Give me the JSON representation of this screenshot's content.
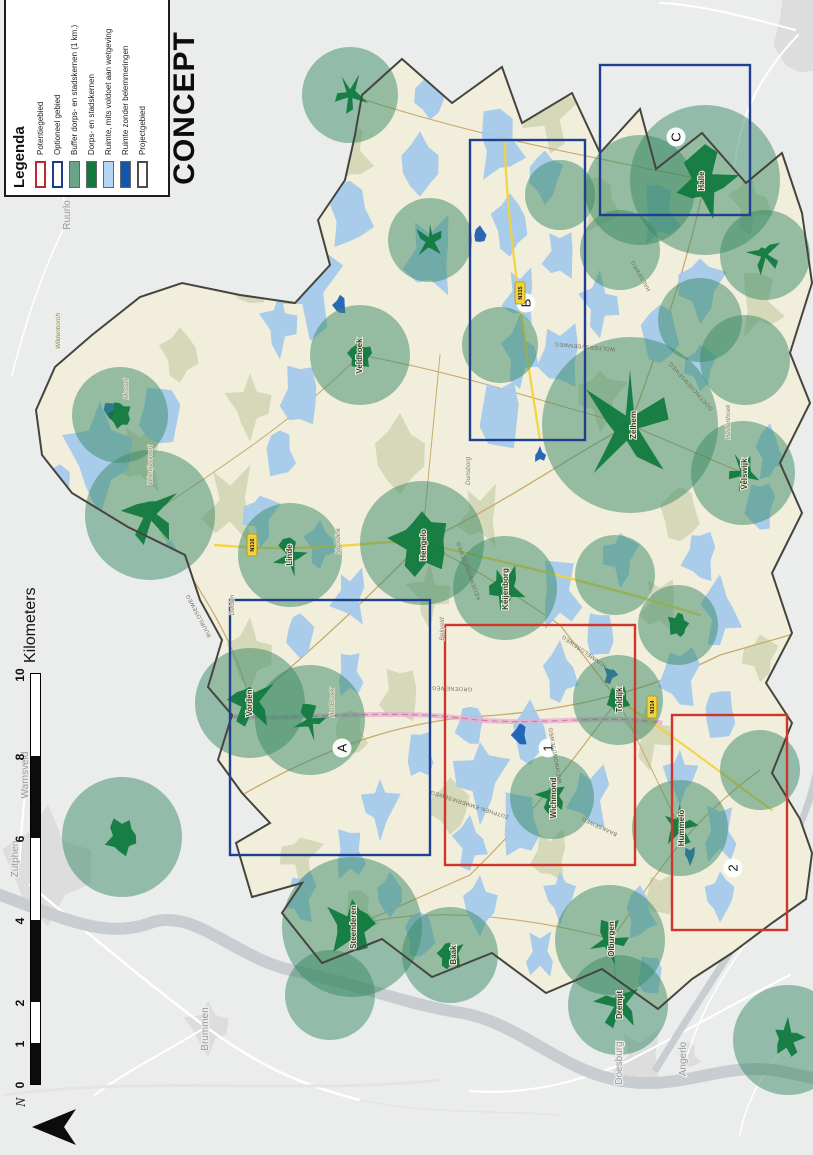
{
  "page": {
    "concept_label": "CONCEPT"
  },
  "legend": {
    "title": "Legenda",
    "items": [
      {
        "label": "Potentiegebied",
        "swatch": "outline",
        "color": "#c0272d"
      },
      {
        "label": "Optioneel gebied",
        "swatch": "outline",
        "color": "#1d3c87"
      },
      {
        "label": "Buffer dorps- en stadskernen (1 km.)",
        "swatch": "fill",
        "color": "#6ba387"
      },
      {
        "label": "Dorps- en stadskernen",
        "swatch": "fill",
        "color": "#15793f"
      },
      {
        "label": "Ruimte, mits voldoet aan wetgeving",
        "swatch": "fill",
        "color": "#b4d6f3"
      },
      {
        "label": "Ruimte zonder belemmeringen",
        "swatch": "fill",
        "color": "#1157ad"
      },
      {
        "label": "Projectgebied",
        "swatch": "outline",
        "color": "#4d4d4d"
      }
    ]
  },
  "scalebar": {
    "unit_label": "Kilometers",
    "ticks": [
      {
        "label": "0",
        "km": 0
      },
      {
        "label": "1",
        "km": 1
      },
      {
        "label": "2",
        "km": 2
      },
      {
        "label": "4",
        "km": 4
      },
      {
        "label": "6",
        "km": 6
      },
      {
        "label": "8",
        "km": 8
      },
      {
        "label": "10",
        "km": 10
      }
    ],
    "px_per_km": 41,
    "bar_left": 70
  },
  "north_arrow": {
    "label": "N"
  },
  "region_boxes": [
    {
      "label": "A",
      "type": "optioneel",
      "x": 300,
      "y": 230,
      "w": 255,
      "h": 200,
      "lx": 407,
      "ly": 342
    },
    {
      "label": "B",
      "type": "optioneel",
      "x": 715,
      "y": 470,
      "w": 300,
      "h": 115,
      "lx": 852,
      "ly": 526
    },
    {
      "label": "C",
      "type": "optioneel",
      "x": 940,
      "y": 600,
      "w": 150,
      "h": 150,
      "lx": 1018,
      "ly": 676
    },
    {
      "label": "1",
      "type": "potentie",
      "x": 290,
      "y": 445,
      "w": 240,
      "h": 190,
      "lx": 407,
      "ly": 548
    },
    {
      "label": "2",
      "type": "potentie",
      "x": 225,
      "y": 672,
      "w": 215,
      "h": 115,
      "lx": 287,
      "ly": 733
    }
  ],
  "map_features": {
    "buffers": [
      [
        1060,
        350,
        48,
        13
      ],
      [
        915,
        430,
        42,
        12
      ],
      [
        965,
        640,
        55,
        0
      ],
      [
        975,
        705,
        75,
        26
      ],
      [
        900,
        765,
        45,
        13
      ],
      [
        905,
        620,
        40,
        0
      ],
      [
        800,
        360,
        50,
        13
      ],
      [
        810,
        500,
        38,
        0
      ],
      [
        730,
        630,
        88,
        36
      ],
      [
        795,
        745,
        45,
        0
      ],
      [
        835,
        700,
        42,
        0
      ],
      [
        640,
        150,
        65,
        22
      ],
      [
        600,
        290,
        52,
        13
      ],
      [
        612,
        422,
        62,
        29
      ],
      [
        567,
        505,
        52,
        17
      ],
      [
        580,
        615,
        40,
        0
      ],
      [
        682,
        743,
        52,
        13
      ],
      [
        530,
        678,
        40,
        11
      ],
      [
        452,
        250,
        55,
        20
      ],
      [
        435,
        310,
        55,
        12
      ],
      [
        358,
        552,
        42,
        13
      ],
      [
        455,
        618,
        45,
        12
      ],
      [
        327,
        680,
        48,
        14
      ],
      [
        385,
        760,
        40,
        0
      ],
      [
        228,
        352,
        70,
        23
      ],
      [
        200,
        450,
        48,
        13
      ],
      [
        215,
        610,
        55,
        15
      ],
      [
        150,
        618,
        50,
        18
      ],
      [
        318,
        122,
        60,
        16
      ],
      [
        115,
        788,
        55,
        14
      ],
      [
        160,
        330,
        45,
        0
      ],
      [
        960,
        560,
        35,
        0
      ],
      [
        740,
        120,
        48,
        12
      ]
    ],
    "water_light": [
      [
        700,
        100,
        45,
        28
      ],
      [
        740,
        160,
        30,
        20
      ],
      [
        660,
        60,
        25,
        15
      ],
      [
        870,
        310,
        45,
        25
      ],
      [
        940,
        350,
        30,
        20
      ],
      [
        990,
        420,
        28,
        18
      ],
      [
        900,
        430,
        35,
        22
      ],
      [
        830,
        280,
        25,
        15
      ],
      [
        760,
        300,
        30,
        18
      ],
      [
        700,
        280,
        22,
        14
      ],
      [
        640,
        260,
        25,
        15
      ],
      [
        1010,
        500,
        30,
        20
      ],
      [
        1060,
        430,
        22,
        15
      ],
      [
        800,
        560,
        30,
        20
      ],
      [
        850,
        600,
        25,
        16
      ],
      [
        900,
        560,
        22,
        15
      ],
      [
        820,
        660,
        28,
        18
      ],
      [
        870,
        700,
        30,
        20
      ],
      [
        940,
        660,
        25,
        16
      ],
      [
        790,
        700,
        22,
        14
      ],
      [
        740,
        500,
        35,
        20
      ],
      [
        800,
        520,
        28,
        15
      ],
      [
        860,
        520,
        25,
        14
      ],
      [
        930,
        510,
        28,
        16
      ],
      [
        980,
        545,
        25,
        15
      ],
      [
        560,
        560,
        30,
        18
      ],
      [
        600,
        620,
        25,
        15
      ],
      [
        520,
        600,
        22,
        14
      ],
      [
        480,
        560,
        25,
        15
      ],
      [
        560,
        350,
        25,
        15
      ],
      [
        610,
        320,
        20,
        13
      ],
      [
        520,
        300,
        22,
        13
      ],
      [
        480,
        350,
        20,
        12
      ],
      [
        380,
        480,
        35,
        22
      ],
      [
        330,
        520,
        30,
        18
      ],
      [
        420,
        530,
        28,
        16
      ],
      [
        360,
        590,
        30,
        18
      ],
      [
        310,
        470,
        22,
        14
      ],
      [
        430,
        470,
        20,
        13
      ],
      [
        400,
        420,
        22,
        13
      ],
      [
        350,
        380,
        25,
        15
      ],
      [
        300,
        350,
        22,
        14
      ],
      [
        260,
        390,
        20,
        12
      ],
      [
        480,
        680,
        30,
        18
      ],
      [
        540,
        720,
        28,
        16
      ],
      [
        600,
        700,
        25,
        15
      ],
      [
        440,
        720,
        25,
        15
      ],
      [
        380,
        680,
        22,
        14
      ],
      [
        320,
        720,
        25,
        15
      ],
      [
        260,
        720,
        22,
        13
      ],
      [
        650,
        760,
        25,
        14
      ],
      [
        700,
        770,
        22,
        13
      ],
      [
        260,
        300,
        25,
        15
      ],
      [
        220,
        420,
        22,
        14
      ],
      [
        250,
        480,
        25,
        15
      ],
      [
        200,
        540,
        20,
        13
      ],
      [
        260,
        560,
        22,
        13
      ],
      [
        180,
        650,
        20,
        12
      ],
      [
        240,
        640,
        22,
        13
      ],
      [
        590,
        160,
        28,
        16
      ]
    ],
    "water_dark": [
      [
        420,
        520,
        10,
        7
      ],
      [
        480,
        610,
        8,
        6
      ],
      [
        850,
        340,
        9,
        6
      ],
      [
        920,
        480,
        8,
        6
      ],
      [
        300,
        690,
        8,
        5
      ],
      [
        700,
        540,
        7,
        5
      ],
      [
        745,
        110,
        8,
        6
      ]
    ],
    "terrain_patches": [
      [
        500,
        250,
        28
      ],
      [
        650,
        230,
        32
      ],
      [
        750,
        250,
        26
      ],
      [
        880,
        250,
        30
      ],
      [
        1000,
        350,
        26
      ],
      [
        1040,
        550,
        30
      ],
      [
        950,
        600,
        24
      ],
      [
        700,
        400,
        34
      ],
      [
        640,
        480,
        26
      ],
      [
        560,
        430,
        24
      ],
      [
        460,
        400,
        26
      ],
      [
        420,
        350,
        22
      ],
      [
        300,
        300,
        24
      ],
      [
        240,
        360,
        20
      ],
      [
        350,
        450,
        26
      ],
      [
        300,
        550,
        24
      ],
      [
        420,
        650,
        26
      ],
      [
        550,
        660,
        24
      ],
      [
        640,
        680,
        26
      ],
      [
        760,
        600,
        28
      ],
      [
        850,
        760,
        26
      ],
      [
        500,
        760,
        22
      ],
      [
        260,
        660,
        20
      ],
      [
        950,
        750,
        24
      ],
      [
        700,
        140,
        30
      ],
      [
        800,
        180,
        24
      ]
    ]
  },
  "towns": [
    [
      "Zelhem",
      730,
      636,
      "in"
    ],
    [
      "Hengelo",
      610,
      426,
      "in"
    ],
    [
      "Vorden",
      452,
      252,
      "in"
    ],
    [
      "Steenderen",
      228,
      356,
      "in"
    ],
    [
      "Keijenborg",
      566,
      508,
      "in"
    ],
    [
      "Hummelo",
      327,
      684,
      "in"
    ],
    [
      "Halle",
      974,
      704,
      "in"
    ],
    [
      "Drempt",
      150,
      622,
      "in"
    ],
    [
      "Toldijk",
      455,
      622,
      "in"
    ],
    [
      "Wichmond",
      357,
      556,
      "in"
    ],
    [
      "Velswijk",
      681,
      747,
      "in"
    ],
    [
      "Veldhoek",
      799,
      362,
      "in"
    ],
    [
      "Linde",
      600,
      292,
      "in"
    ],
    [
      "Baak",
      200,
      456,
      "in"
    ],
    [
      "Olburgen",
      216,
      614,
      "in"
    ],
    [
      "Zutphen",
      296,
      18,
      "out"
    ],
    [
      "Warnsveld",
      380,
      28,
      "out"
    ],
    [
      "Brummen",
      126,
      208,
      "out"
    ],
    [
      "Doesburg",
      92,
      622,
      "out"
    ],
    [
      "Angerlo",
      96,
      686,
      "out"
    ],
    [
      "Ruurlo",
      940,
      70,
      "out"
    ],
    [
      "Wildenborch",
      824,
      60,
      "area"
    ],
    [
      "Mossel",
      766,
      128,
      "area"
    ],
    [
      "Wientjesvoort",
      690,
      152,
      "area"
    ],
    [
      "Delden",
      550,
      234,
      "area"
    ],
    [
      "Het Broek",
      452,
      334,
      "area"
    ],
    [
      "Noordink",
      614,
      340,
      "area"
    ],
    [
      "Dunsborg",
      684,
      470,
      "area"
    ],
    [
      "Bekveld",
      526,
      444,
      "area"
    ],
    [
      "Heidenhoek",
      733,
      730,
      "area"
    ]
  ],
  "road_labels": [
    [
      "ZUTPHEN-EMMERIKSEWEG",
      352,
      470,
      -72
    ],
    [
      "GROENEWEG",
      468,
      452,
      -88
    ],
    [
      "RUURLOSEWEG",
      540,
      200,
      -28
    ],
    [
      "HUMMELOSEWEG",
      505,
      585,
      -55
    ],
    [
      "KEIJENBORGSEWEG",
      585,
      470,
      -20
    ],
    [
      "WOLFERSVEENWEG",
      810,
      585,
      -85
    ],
    [
      "HALSEWEG",
      880,
      642,
      -30
    ],
    [
      "DOETINCHEMSEWEG",
      770,
      692,
      -42
    ],
    [
      "BAAKSEWEG",
      330,
      600,
      -65
    ],
    [
      "WICHMONDSEWEG",
      400,
      557,
      -10
    ]
  ],
  "road_shields": [
    [
      "N314",
      448,
      652
    ],
    [
      "N315",
      862,
      520
    ],
    [
      "N316",
      610,
      252
    ]
  ],
  "colors": {
    "outside_bg": "#ebedec",
    "outside_road": "#ffffff",
    "builtup": "#dcdddc",
    "river": "#c7cdd1",
    "muni_fill": "#f1efdb",
    "boundary": "#45453e",
    "terrain": "#c9cfab",
    "water_light": "#a4c9eb",
    "water_dark": "#1d5fb5",
    "buffer": "#3a8a66",
    "core": "#0e7a3d",
    "box_red": "#cf352b",
    "box_blue": "#203f8e",
    "pink_corridor": "#e9aed0",
    "pink_line": "#cf7fae",
    "yellow_road": "#f3d23c",
    "tan_road": "#c9a96e"
  }
}
